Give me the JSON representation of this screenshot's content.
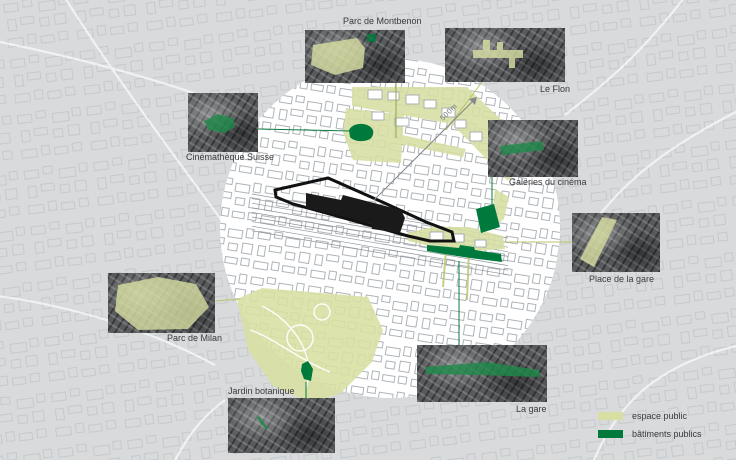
{
  "diagram": {
    "scale_label": "500m",
    "callouts": [
      {
        "id": "parc-de-montbenon",
        "label": "Parc de Montbenon",
        "category": "espace public"
      },
      {
        "id": "le-flon",
        "label": "Le Flon",
        "category": "espace public"
      },
      {
        "id": "cinematheque-suisse",
        "label": "Cinémathèque Suisse",
        "category": "bâtiments publics"
      },
      {
        "id": "galeries-du-cinema",
        "label": "Galeries du cinéma",
        "category": "bâtiments publics"
      },
      {
        "id": "place-de-la-gare",
        "label": "Place de la gare",
        "category": "espace public"
      },
      {
        "id": "parc-de-milan",
        "label": "Parc de Milan",
        "category": "espace public"
      },
      {
        "id": "jardin-botanique",
        "label": "Jardin botanique",
        "category": "bâtiments publics"
      },
      {
        "id": "la-gare",
        "label": "La gare",
        "category": "bâtiments publics"
      }
    ],
    "legend": {
      "items": [
        {
          "id": "espace-public",
          "label": "espace public",
          "color": "#d8dfa2"
        },
        {
          "id": "batiments-publics",
          "label": "bâtiments publics",
          "color": "#007a3c"
        }
      ]
    },
    "colors": {
      "espace_public": "#d8dfa2",
      "batiments_publics": "#007a3c",
      "site": "#1a1a1a",
      "background": "#d8dadb",
      "study_circle": "#ffffff"
    }
  }
}
